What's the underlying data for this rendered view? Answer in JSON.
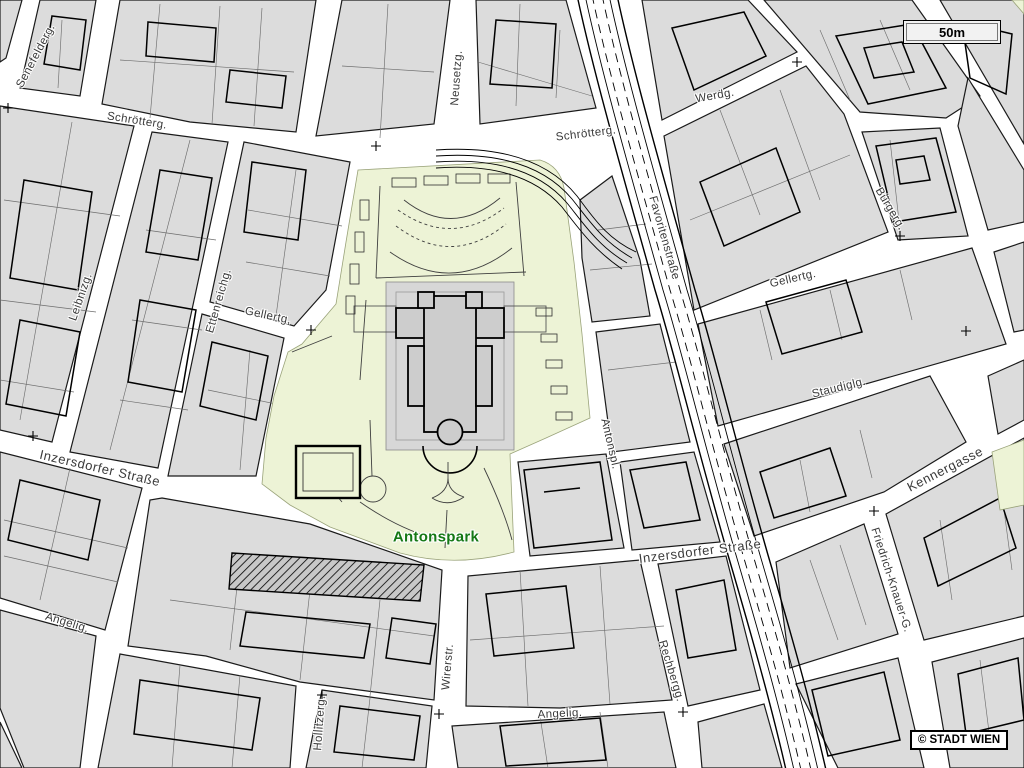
{
  "map": {
    "street_labels": [
      {
        "id": "senefeldergasse",
        "text": "Senefelderg."
      },
      {
        "id": "schroettergasse-west",
        "text": "Schrötterg."
      },
      {
        "id": "neusetzgasse",
        "text": "Neusetzg."
      },
      {
        "id": "schroettergasse-east",
        "text": "Schrötterg."
      },
      {
        "id": "werdgasse",
        "text": "Werdg."
      },
      {
        "id": "favoritenstrasse",
        "text": "Favoritenstraße"
      },
      {
        "id": "buergergasse",
        "text": "Bürgerg."
      },
      {
        "id": "leibnizgasse",
        "text": "Leibnizg."
      },
      {
        "id": "ettenreichgasse",
        "text": "Ettenreichg."
      },
      {
        "id": "gellertgasse-west",
        "text": "Gellertg."
      },
      {
        "id": "gellertgasse-east",
        "text": "Gellertg."
      },
      {
        "id": "staudiglgasse",
        "text": "Staudiglg."
      },
      {
        "id": "inzersdorfer-strasse-west",
        "text": "Inzersdorfer Straße"
      },
      {
        "id": "antonsplatz",
        "text": "Antonspl."
      },
      {
        "id": "inzersdorfer-strasse-east",
        "text": "Inzersdorfer Straße"
      },
      {
        "id": "rechberggasse",
        "text": "Rechbergg."
      },
      {
        "id": "kennergasse",
        "text": "Kennergasse"
      },
      {
        "id": "friedrich-knauer-gasse",
        "text": "Friedrich-Knauer-G."
      },
      {
        "id": "angeligasse-west",
        "text": "Angelig."
      },
      {
        "id": "angeligasse-mid",
        "text": "Angelig."
      },
      {
        "id": "wirerstrasse",
        "text": "Wirerstr."
      },
      {
        "id": "hollitzergasse",
        "text": "Hollitzerg."
      }
    ],
    "park_label": {
      "text": "Antonspark"
    },
    "scale_bar": {
      "text": "50m"
    },
    "copyright": {
      "text": "© STADT WIEN"
    },
    "colors": {
      "street": "#ffffff",
      "block": "#dcdcdc",
      "outline": "#1a1a1a",
      "park": "#edf3d6",
      "plaza": "#d7d7d7",
      "church": "#cdcdcd",
      "label": "#3a3a3a",
      "parklabel": "#157815"
    }
  }
}
